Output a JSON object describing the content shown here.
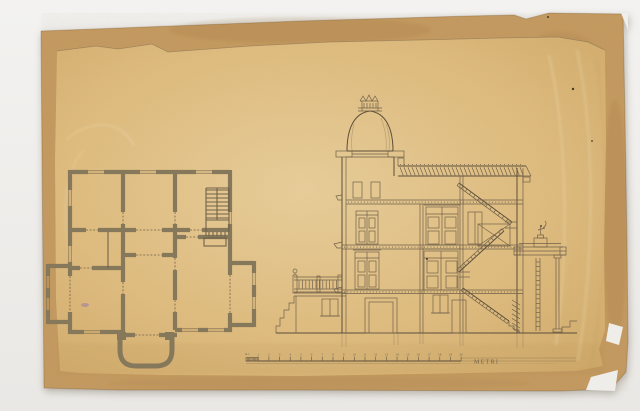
{
  "scale_bar": {
    "left_label": "m.1",
    "unit_label": "METRI",
    "tick_labels": [
      "1",
      "2",
      "3",
      "4",
      "5",
      "6",
      "7",
      "8",
      "9",
      "10",
      "11",
      "12",
      "13",
      "14",
      "15",
      "16",
      "17",
      "18",
      "19",
      "20"
    ]
  },
  "colors": {
    "photo_background": "#f3f2f0",
    "photo_background_bottom": "#eae8e5",
    "mount_paper": "#c49a60",
    "mount_edge_shade": "#a87e47",
    "sheet_paper": "#ddb87a",
    "sheet_paper_light": "#e9cf9b",
    "sheet_paper_dark": "#d0aa6a",
    "ink": "#6f6049",
    "ink_strong": "#5a4c38",
    "wall_poche": "#85775a",
    "speck": "#463724",
    "stain_purple": "#8a6fae"
  }
}
